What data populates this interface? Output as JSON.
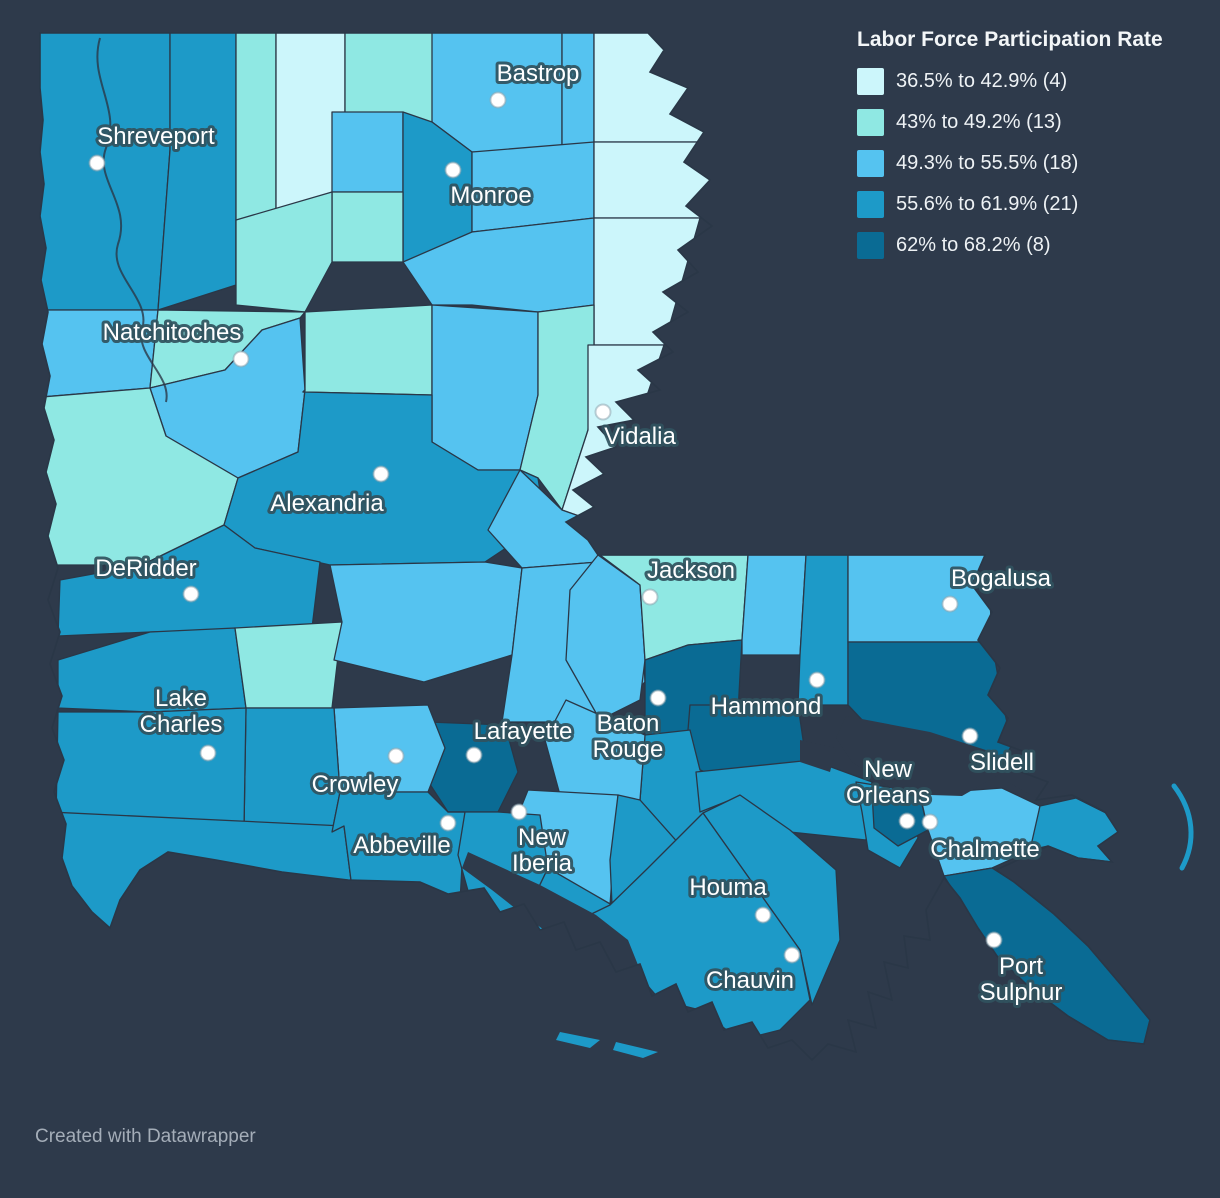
{
  "legend": {
    "title": "Labor Force Participation Rate",
    "items": [
      {
        "label": "36.5% to 42.9% (4)",
        "color": "#ccf6fb"
      },
      {
        "label": "43% to 49.2% (13)",
        "color": "#8fe8e3"
      },
      {
        "label": "49.3% to 55.5% (18)",
        "color": "#55c3f0"
      },
      {
        "label": "55.6% to 61.9% (21)",
        "color": "#1d9ac8"
      },
      {
        "label": "62% to 68.2% (8)",
        "color": "#0a6b94"
      }
    ]
  },
  "map": {
    "region": "Louisiana parishes choropleth",
    "background": "#2e3a4b",
    "border_color": "#2a3747",
    "label_color": "#ffffff",
    "label_halo": "#31525e",
    "cities": [
      {
        "name": "Shreveport",
        "x": 97,
        "y": 163,
        "lines": [
          "Shreveport"
        ],
        "lx": 156,
        "ly": 144
      },
      {
        "name": "Bastrop",
        "x": 498,
        "y": 100,
        "lines": [
          "Bastrop"
        ],
        "lx": 538,
        "ly": 81
      },
      {
        "name": "Monroe",
        "x": 453,
        "y": 170,
        "lines": [
          "Monroe"
        ],
        "lx": 491,
        "ly": 203
      },
      {
        "name": "Natchitoches",
        "x": 241,
        "y": 359,
        "lines": [
          "Natchitoches"
        ],
        "lx": 172,
        "ly": 340
      },
      {
        "name": "Vidalia",
        "x": 603,
        "y": 412,
        "lines": [
          "Vidalia"
        ],
        "lx": 640,
        "ly": 444
      },
      {
        "name": "Alexandria",
        "x": 381,
        "y": 474,
        "lines": [
          "Alexandria"
        ],
        "lx": 327,
        "ly": 511
      },
      {
        "name": "DeRidder",
        "x": 191,
        "y": 594,
        "lines": [
          "DeRidder"
        ],
        "lx": 146,
        "ly": 576
      },
      {
        "name": "Jackson",
        "x": 650,
        "y": 597,
        "lines": [
          "Jackson"
        ],
        "lx": 691,
        "ly": 578
      },
      {
        "name": "Bogalusa",
        "x": 950,
        "y": 604,
        "lines": [
          "Bogalusa"
        ],
        "lx": 1001,
        "ly": 586
      },
      {
        "name": "Lake Charles",
        "x": 208,
        "y": 753,
        "lines": [
          "Lake",
          "Charles"
        ],
        "lx": 181,
        "ly": 706
      },
      {
        "name": "Crowley",
        "x": 396,
        "y": 756,
        "lines": [
          "Crowley"
        ],
        "lx": 355,
        "ly": 792
      },
      {
        "name": "Lafayette",
        "x": 474,
        "y": 755,
        "lines": [
          "Lafayette"
        ],
        "lx": 523,
        "ly": 739
      },
      {
        "name": "Baton Rouge",
        "x": 658,
        "y": 698,
        "lines": [
          "Baton",
          "Rouge"
        ],
        "lx": 628,
        "ly": 731
      },
      {
        "name": "Hammond",
        "x": 817,
        "y": 680,
        "lines": [
          "Hammond"
        ],
        "lx": 766,
        "ly": 714
      },
      {
        "name": "New Orleans",
        "x": 907,
        "y": 821,
        "lines": [
          "New",
          "Orleans"
        ],
        "lx": 888,
        "ly": 777
      },
      {
        "name": "Slidell",
        "x": 970,
        "y": 736,
        "lines": [
          "Slidell"
        ],
        "lx": 1002,
        "ly": 770
      },
      {
        "name": "Chalmette",
        "x": 930,
        "y": 822,
        "lines": [
          "Chalmette"
        ],
        "lx": 985,
        "ly": 857
      },
      {
        "name": "Abbeville",
        "x": 448,
        "y": 823,
        "lines": [
          "Abbeville"
        ],
        "lx": 402,
        "ly": 853
      },
      {
        "name": "New Iberia",
        "x": 519,
        "y": 812,
        "lines": [
          "New",
          "Iberia"
        ],
        "lx": 542,
        "ly": 845
      },
      {
        "name": "Houma",
        "x": 763,
        "y": 915,
        "lines": [
          "Houma"
        ],
        "lx": 728,
        "ly": 895
      },
      {
        "name": "Chauvin",
        "x": 792,
        "y": 955,
        "lines": [
          "Chauvin"
        ],
        "lx": 750,
        "ly": 988
      },
      {
        "name": "Port Sulphur",
        "x": 994,
        "y": 940,
        "lines": [
          "Port",
          "Sulphur"
        ],
        "lx": 1021,
        "ly": 974
      }
    ]
  },
  "footer": {
    "credit": "Created with Datawrapper"
  }
}
